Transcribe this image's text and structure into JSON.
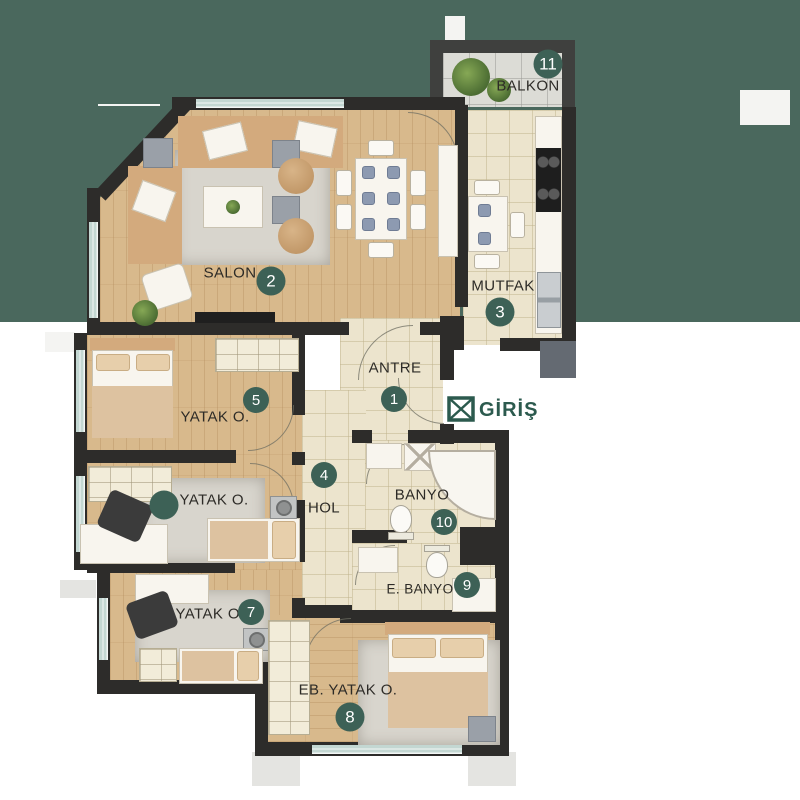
{
  "scene": {
    "title": "apartment-floor-plan",
    "background_band_color": "#4a685d",
    "page_color": "#ffffff",
    "marker_color": "#3d6156",
    "wall_color": "#2d2c2a"
  },
  "rooms": [
    {
      "id": "antre",
      "label": "ANTRE",
      "number": "1"
    },
    {
      "id": "salon",
      "label": "SALON",
      "number": "2"
    },
    {
      "id": "mutfak",
      "label": "MUTFAK",
      "number": "3"
    },
    {
      "id": "hol",
      "label": "HOL",
      "number": "4"
    },
    {
      "id": "yatak-odasi-5",
      "label": "YATAK O.",
      "number": "5"
    },
    {
      "id": "yatak-odasi-orta",
      "label": "YATAK O.",
      "number": ""
    },
    {
      "id": "yatak-odasi-7",
      "label": "YATAK O.",
      "number": "7"
    },
    {
      "id": "ebeveyn-yatak",
      "label": "EB. YATAK O.",
      "number": "8"
    },
    {
      "id": "ebeveyn-banyo",
      "label": "E. BANYO",
      "number": "9"
    },
    {
      "id": "banyo",
      "label": "BANYO",
      "number": "10"
    },
    {
      "id": "balkon",
      "label": "BALKON",
      "number": "11"
    }
  ],
  "entrance": {
    "label": "GİRİŞ",
    "icon": "entrance-x-icon",
    "color": "#2c5a4e"
  }
}
